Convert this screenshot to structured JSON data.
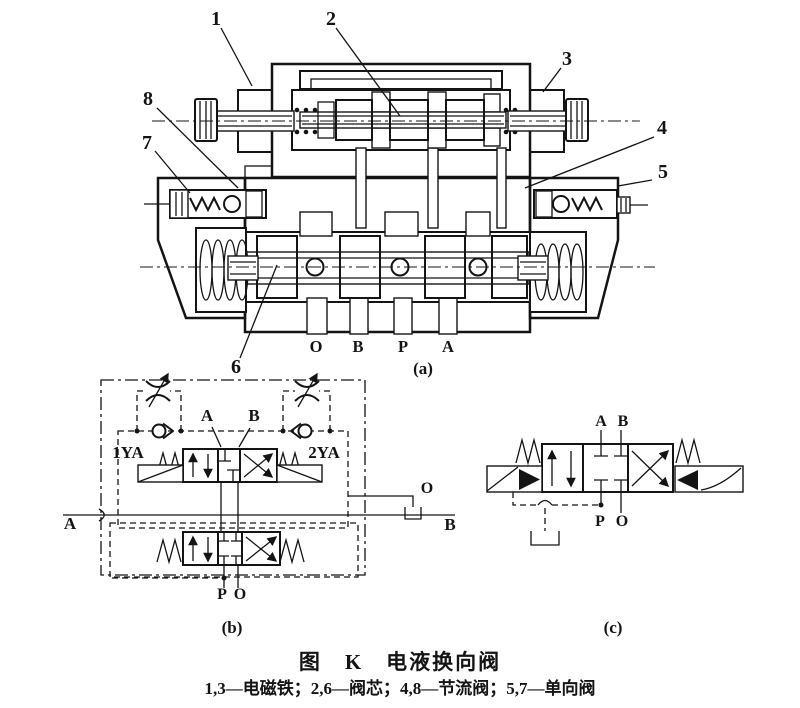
{
  "caption": {
    "title": "图　K　电液换向阀",
    "legend": "1,3—电磁铁；2,6—阀芯；4,8—节流阀；5,7—单向阀"
  },
  "panel_a": {
    "label": "(a)",
    "callouts": {
      "n1": "1",
      "n2": "2",
      "n3": "3",
      "n4": "4",
      "n5": "5",
      "n6": "6",
      "n7": "7",
      "n8": "8"
    },
    "ports": {
      "o": "O",
      "b": "B",
      "p": "P",
      "a": "A"
    }
  },
  "panel_b": {
    "label": "(b)",
    "solenoid_left": "1YA",
    "solenoid_right": "2YA",
    "port_a_top": "A",
    "port_b_top": "B",
    "port_a_side": "A",
    "port_b_side": "B",
    "port_o_side": "O",
    "port_p_bottom": "P",
    "port_o_bottom": "O"
  },
  "panel_c": {
    "label": "(c)",
    "port_a": "A",
    "port_b": "B",
    "port_p": "P",
    "port_o": "O"
  },
  "colors": {
    "ink": "#141414",
    "paper": "#ffffff"
  }
}
